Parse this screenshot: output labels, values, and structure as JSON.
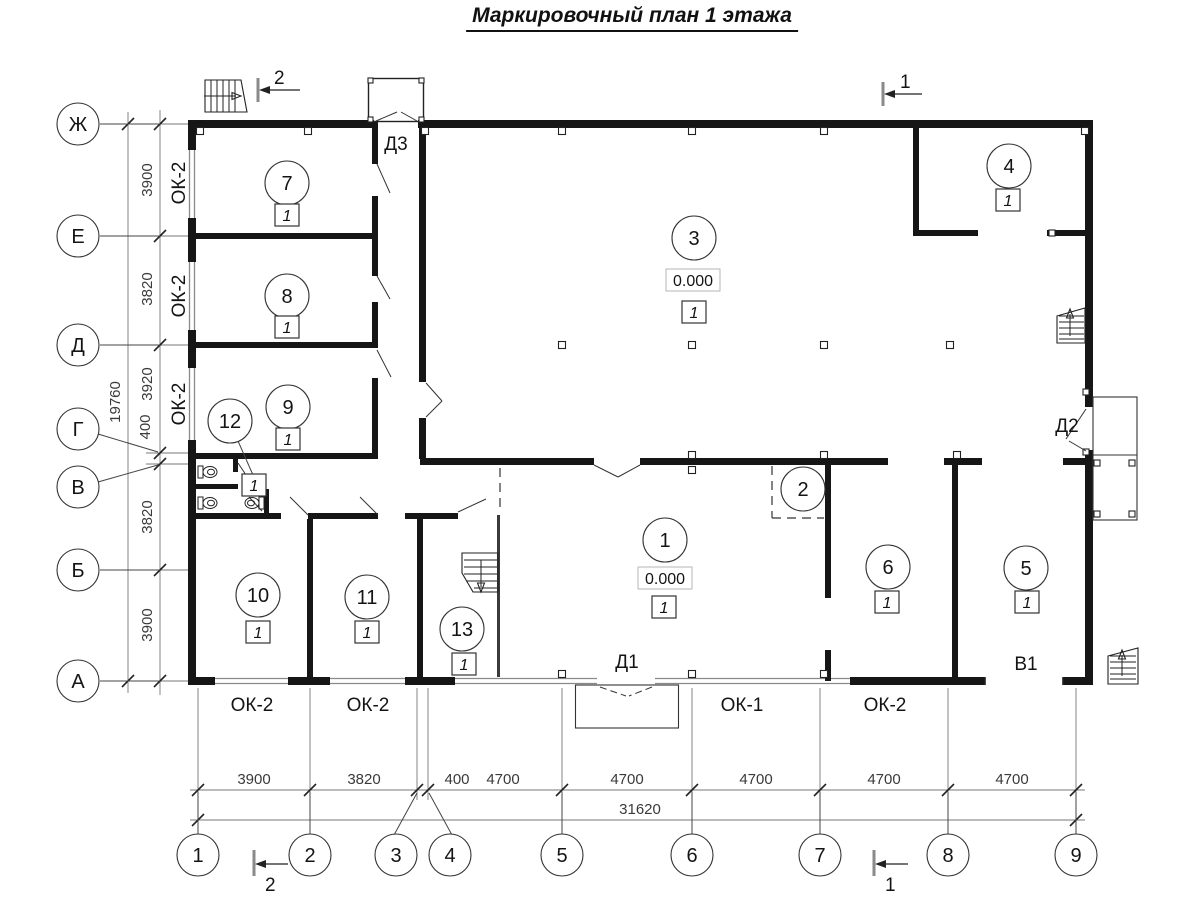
{
  "title": "Маркировочный план 1 этажа",
  "axes": {
    "rows": [
      "Ж",
      "Е",
      "Д",
      "Г",
      "В",
      "Б",
      "А"
    ],
    "cols": [
      "1",
      "2",
      "3",
      "4",
      "5",
      "6",
      "7",
      "8",
      "9"
    ]
  },
  "dims": {
    "left": [
      "3900",
      "3820",
      "3920",
      "400",
      "3820",
      "3900"
    ],
    "left_total": "19760",
    "bottom": [
      "3900",
      "3820",
      "400",
      "4700",
      "4700",
      "4700",
      "4700",
      "4700"
    ],
    "bottom_total": "31620"
  },
  "rooms": {
    "r1": {
      "num": "1",
      "floor": "1",
      "elevation": "0.000"
    },
    "r2": {
      "num": "2"
    },
    "r3": {
      "num": "3",
      "floor": "1",
      "elevation": "0.000"
    },
    "r4": {
      "num": "4",
      "floor": "1"
    },
    "r5": {
      "num": "5",
      "floor": "1"
    },
    "r6": {
      "num": "6",
      "floor": "1"
    },
    "r7": {
      "num": "7",
      "floor": "1"
    },
    "r8": {
      "num": "8",
      "floor": "1"
    },
    "r9": {
      "num": "9",
      "floor": "1"
    },
    "r10": {
      "num": "10",
      "floor": "1"
    },
    "r11": {
      "num": "11",
      "floor": "1"
    },
    "r12": {
      "num": "12",
      "floor": "1"
    },
    "r13": {
      "num": "13",
      "floor": "1"
    }
  },
  "doors": {
    "d1": "Д1",
    "d2": "Д2",
    "d3": "Д3",
    "v1": "В1"
  },
  "windows": {
    "left": [
      "ОК-2",
      "ОК-2",
      "ОК-2"
    ],
    "bottom": [
      "ОК-2",
      "ОК-2",
      "ОК-1",
      "ОК-2"
    ]
  },
  "sections": {
    "s1": "1",
    "s2": "2"
  }
}
